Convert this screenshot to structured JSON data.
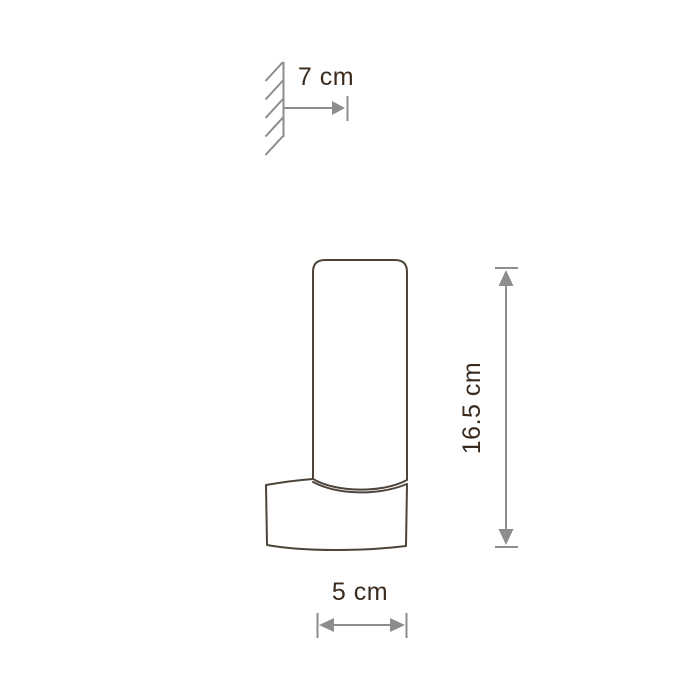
{
  "drawing": {
    "labels": {
      "depth": "7 cm",
      "height": "16.5 cm",
      "width": "5 cm"
    }
  },
  "colors": {
    "background": "#ffffff",
    "lamp_outline": "#4d453c",
    "dimension_lines": "#8d8d8d",
    "label_text": "#3a2b1e"
  }
}
